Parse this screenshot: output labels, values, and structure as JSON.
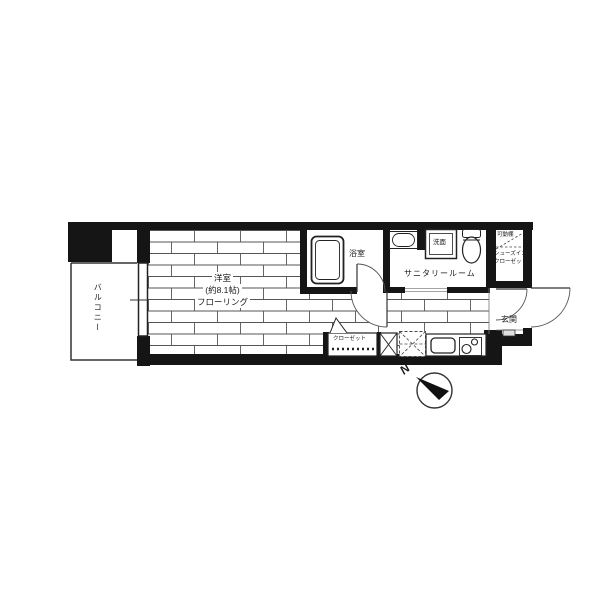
{
  "floorplan": {
    "balcony": {
      "label": "バルコニー"
    },
    "western_room": {
      "name": "洋室",
      "size": "(約8.1帖)",
      "floor": "フローリング"
    },
    "bathroom": {
      "label": "浴室"
    },
    "sanitary_room": {
      "label": "サニタリールーム",
      "washbasin": "洗面"
    },
    "shoes_in_closet": {
      "shelf": "可動棚",
      "line1": "シューズイン",
      "line2": "クローゼット"
    },
    "entrance": {
      "label": "玄関"
    },
    "closet": {
      "label": "クローゼット"
    },
    "compass": {
      "north": "N"
    }
  },
  "colors": {
    "wall": "#151515",
    "line": "#333333",
    "bg": "#ffffff"
  }
}
